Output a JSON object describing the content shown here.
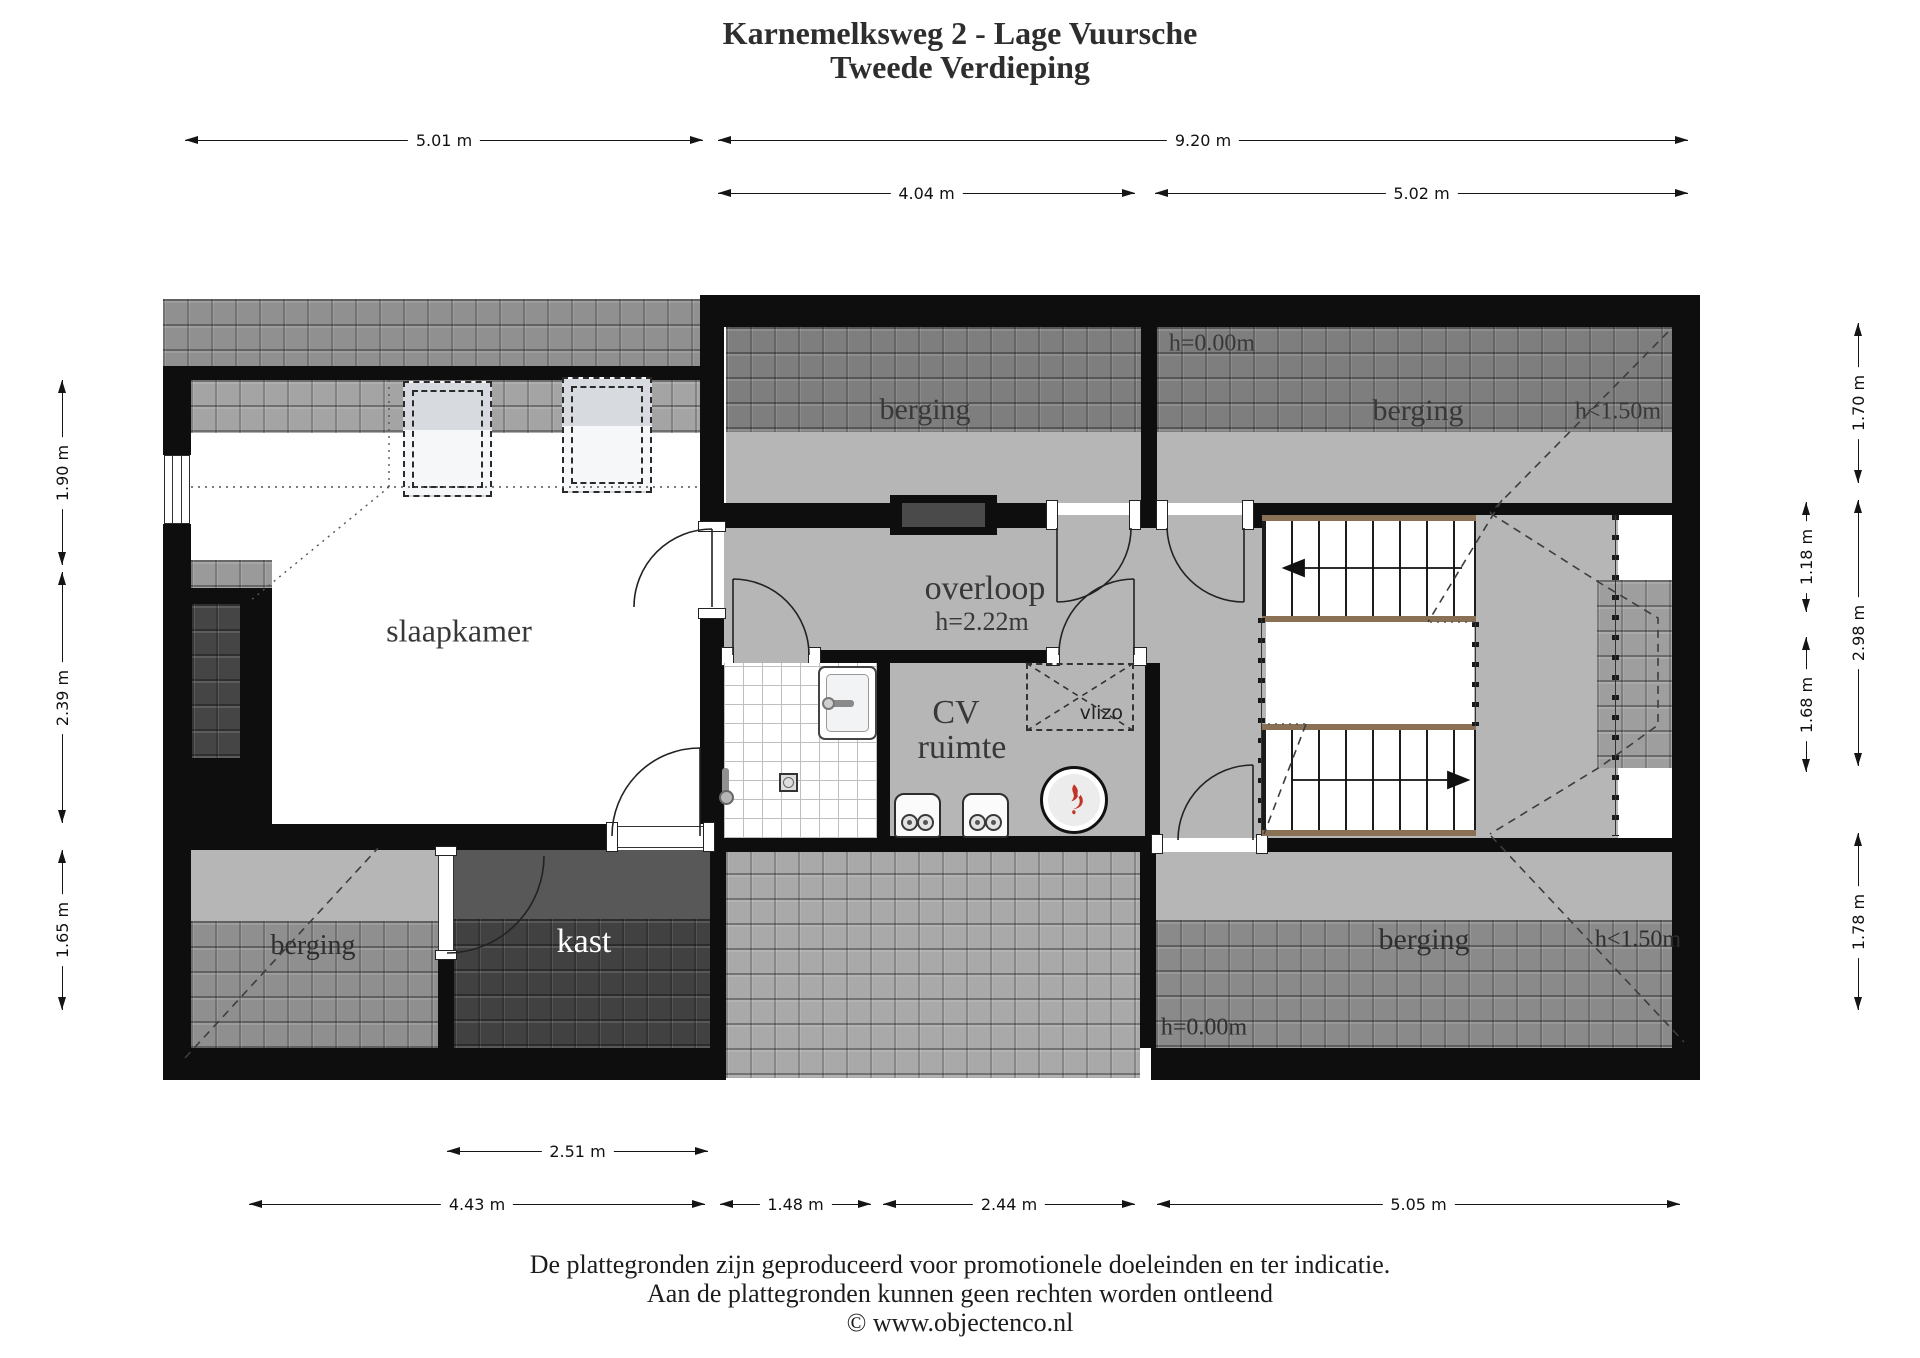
{
  "title": {
    "line1": "Karnemelksweg 2 - Lage Vuursche",
    "line2": "Tweede Verdieping"
  },
  "dimensions": {
    "top_row": [
      {
        "label": "5.01 m"
      },
      {
        "label": "9.20 m"
      }
    ],
    "top_row2": [
      {
        "label": "4.04 m"
      },
      {
        "label": "5.02 m"
      }
    ],
    "left_col": [
      {
        "label": "1.90 m"
      },
      {
        "label": "2.39 m"
      },
      {
        "label": "1.65 m"
      }
    ],
    "right_inner": [
      {
        "label": "1.18 m"
      },
      {
        "label": "1.68 m"
      }
    ],
    "right_outer": [
      {
        "label": "1.70 m"
      },
      {
        "label": "2.98 m"
      },
      {
        "label": "1.78 m"
      }
    ],
    "bottom_row": [
      {
        "label": "2.51 m"
      }
    ],
    "bottom_row2": [
      {
        "label": "4.43 m"
      },
      {
        "label": "1.48 m"
      },
      {
        "label": "2.44 m"
      },
      {
        "label": "5.05 m"
      }
    ]
  },
  "rooms": {
    "slaapkamer": {
      "label": "slaapkamer"
    },
    "berging_top_left": {
      "label": "berging"
    },
    "berging_top_right": {
      "label": "berging"
    },
    "overloop": {
      "label": "overloop",
      "height": "h=2.22m"
    },
    "cv_ruimte": {
      "line1": "CV",
      "line2": "ruimte"
    },
    "vlizo": {
      "label": "vlizo"
    },
    "kast": {
      "label": "kast"
    },
    "berging_bottom_left": {
      "label": "berging"
    },
    "berging_bottom_right": {
      "label": "berging"
    }
  },
  "annotations": {
    "top_height_zero": "h=0.00m",
    "top_height_lt150": "h<1.50m",
    "bottom_height_zero": "h=0.00m",
    "bottom_height_lt150": "h<1.50m"
  },
  "footer": {
    "line1": "De plattegronden zijn geproduceerd voor promotionele doeleinden en ter indicatie.",
    "line2": "Aan de plattegronden kunnen geen rechten worden ontleend",
    "line3": "© www.objectenco.nl"
  },
  "colors": {
    "wall": "#0e0e0e",
    "floor_gray": "#b6b6b6",
    "roof_tile_gray": "#7e7e7e",
    "stair_nosing_brown": "#8a7156",
    "flame_red": "#c13327"
  }
}
